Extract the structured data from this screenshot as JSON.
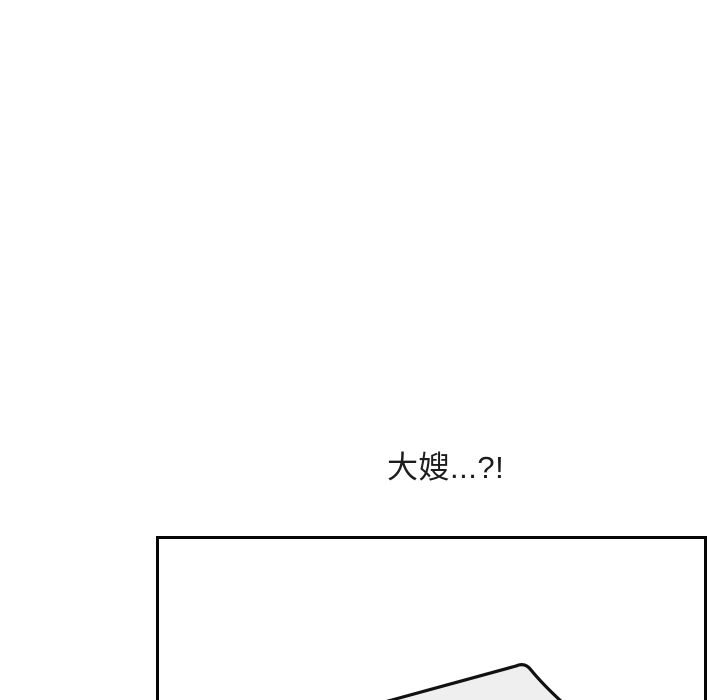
{
  "page": {
    "background_color": "#ffffff",
    "speech": {
      "text": "大嫂...?!",
      "color": "#1c1c1c"
    }
  },
  "panel": {
    "border_color": "#060606",
    "background_color": "#ffffff",
    "artwork": {
      "object_name": "tilted-object-edge",
      "fill_color": "#efefef",
      "stroke_color": "#111111",
      "shadow_color": "#b5b5b5"
    }
  }
}
